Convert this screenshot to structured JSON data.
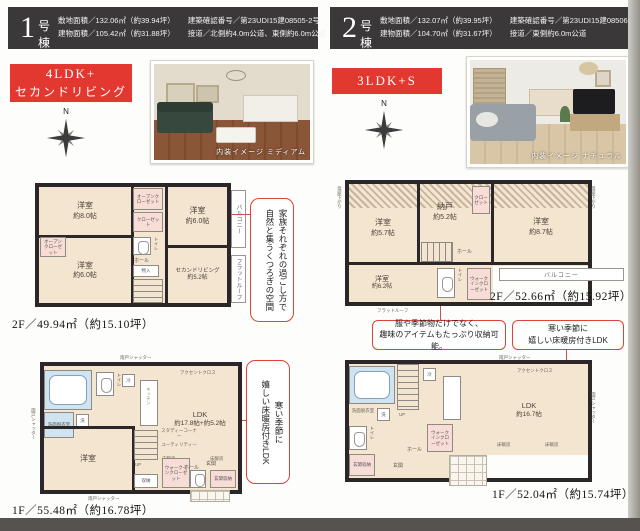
{
  "colors": {
    "accent_red": "#e2382f",
    "header_dark": "#3b383a",
    "plan_beige": "#f4e5d0",
    "closet_pink": "#f8dcd6",
    "bath_blue": "#cfe3f0"
  },
  "b1": {
    "num": "1",
    "suffix": "号棟",
    "spec1": "敷地面積／132.06㎡（約39.94坪）",
    "spec2": "建物面積／105.42㎡（約31.88坪）",
    "spec3": "建築確認番号／第23UDI15建08505-2号",
    "spec4": "接道／北側約4.0m公道、東側約6.0m公道",
    "badge1": "4LDK+",
    "badge2": "セカンドリビング",
    "compass": "N",
    "photo_caption": "内装イメージ ミディアム",
    "note2f_a": "家族それぞれの過ごし方で",
    "note2f_b": "自然と集うくつろぎの空間",
    "note1f_a": "寒い季節に",
    "note1f_b": "嬉しい床暖房付きLDK",
    "f2": {
      "caption": "2F／49.94㎡（約15.10坪）",
      "r1n": "洋室",
      "r1s": "約8.0帖",
      "r2n": "洋室",
      "r2s": "約6.0帖",
      "r3n": "洋室",
      "r3s": "約6.0帖",
      "r4n": "セカンドリビング",
      "r4s": "約5.2帖",
      "balcony": "バルコニー",
      "flatroof": "フラットルーフ",
      "hall": "ホール",
      "toilet": "トイレ",
      "closet1": "オープンクローゼット",
      "closet2": "クローゼット",
      "closet3": "オープンクローゼット",
      "storage": "物入"
    },
    "f1": {
      "caption": "1F／55.48㎡（約16.78坪）",
      "ldk": "LDK",
      "ldks": "約17.8帖+約5.2帖",
      "bed": "洋室",
      "wash": "洗面脱衣室",
      "washer": "洗",
      "fridge": "冷",
      "kitchen": "キッチン",
      "toilet": "トイレ",
      "hall": "ホール",
      "entrance": "玄関",
      "entst": "玄関収納",
      "wic": "ウォークインクローゼット",
      "storage": "収納",
      "study": "スタディーコーナー",
      "utility": "ユーティリティー",
      "accent": "アクセントクロス",
      "yukadan": "床暖房",
      "up": "UP",
      "shutter": "雨戸シャッター"
    }
  },
  "b2": {
    "num": "2",
    "suffix": "号棟",
    "spec1": "敷地面積／132.07㎡（約39.95坪）",
    "spec2": "建物面積／104.70㎡（約31.67坪）",
    "spec3": "建築確認番号／第23UDI15建08506号",
    "spec4": "接道／東側約6.0m公道",
    "badge1": "3LDK+S",
    "compass": "N",
    "photo_caption": "内装イメージ ナチュラル",
    "note_a1": "服や季節物だけでなく、",
    "note_a2": "趣味のアイテムもたっぷり収納可能。",
    "note_b1": "寒い季節に",
    "note_b2": "嬉しい床暖房付きLDK",
    "f2": {
      "caption": "2F／52.66㎡（約15.92坪）",
      "r1n": "洋室",
      "r1s": "約5.7帖",
      "r2n": "納戸",
      "r2s": "約5.2帖",
      "r3n": "洋室",
      "r3s": "約8.7帖",
      "r4n": "洋室",
      "r4s": "約6.2帖",
      "balcony": "バルコニー",
      "flatroof": "フラットルーフ",
      "hall": "ホール",
      "toilet": "トイレ",
      "closet": "クローゼット",
      "wic": "ウォークインクローゼット",
      "slope": "母屋下がり"
    },
    "f1": {
      "caption": "1F／52.04㎡（約15.74坪）",
      "ldk": "LDK",
      "ldks": "約16.7帖",
      "wash": "洗面脱衣室",
      "washer": "洗",
      "fridge": "冷",
      "toilet": "トイレ",
      "hall": "ホール",
      "entrance": "玄関",
      "entst": "玄関収納",
      "wic": "ウォークインクローゼット",
      "accent": "アクセントクロス",
      "yukadan": "床暖房",
      "up": "UP",
      "shutter": "雨戸シャッター"
    }
  }
}
